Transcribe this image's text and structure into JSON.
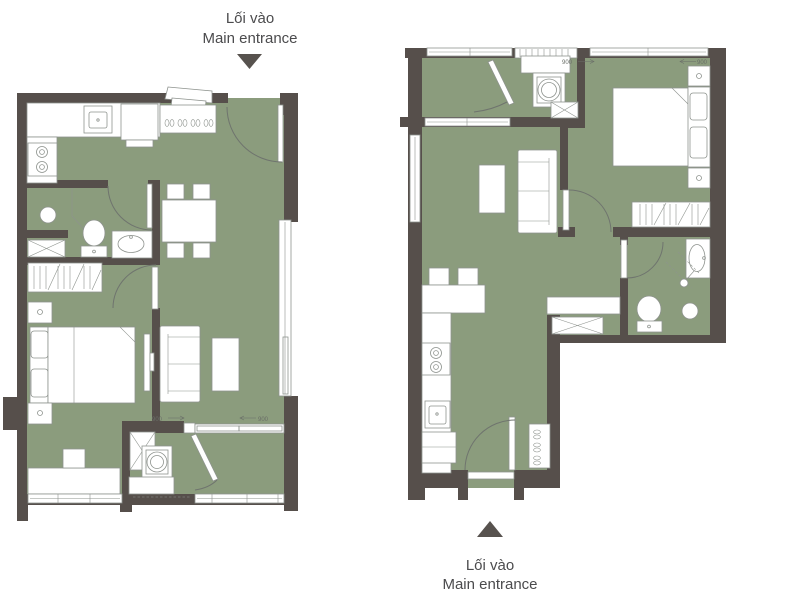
{
  "canvas": {
    "width": 800,
    "height": 602,
    "background": "#ffffff"
  },
  "colors": {
    "wall": "#564f4b",
    "floor_green": "#8b9c7d",
    "fixture_fill": "#ffffff",
    "fixture_stroke": "#8e938e",
    "door_arc": "#6f746e",
    "label_text": "#4b4b4d",
    "entrance_arrow": "#57524e",
    "dimension_text": "#6a6e68"
  },
  "top_entrance": {
    "line1": "Lối vào",
    "line2": "Main entrance"
  },
  "bottom_entrance": {
    "line1": "Lối vào",
    "line2": "Main entrance"
  },
  "dimensions": {
    "left_slide_a": "900",
    "left_slide_b": "900",
    "right_slide_a": "900",
    "right_slide_b": "900"
  },
  "plans": [
    {
      "name": "apartment-plan-left",
      "entrance": "top-right",
      "rooms": [
        "kitchen",
        "bathroom",
        "wardrobe",
        "bedroom",
        "living-dining",
        "laundry-closet",
        "balcony"
      ],
      "fixtures": [
        "kitchen-counter",
        "sink",
        "stove",
        "fridge",
        "shoe-cabinet",
        "shower",
        "toilet",
        "vanity-basin",
        "storage-cabinet",
        "bed",
        "nightstands",
        "desk",
        "stool",
        "tv",
        "sofa",
        "coffee-table",
        "dining-table",
        "dining-chairs",
        "washing-machine",
        "sliding-door",
        "windows"
      ]
    },
    {
      "name": "apartment-plan-right",
      "entrance": "bottom-left",
      "rooms": [
        "balcony",
        "laundry",
        "bedroom",
        "living",
        "hall",
        "bathroom",
        "kitchen"
      ],
      "fixtures": [
        "washing-machine",
        "storage-cabinet",
        "bed",
        "nightstands",
        "wardrobe",
        "sofa",
        "coffee-table",
        "hall-counter",
        "bathtub-basin",
        "shower",
        "toilet",
        "bar-counter",
        "bar-stools",
        "stove",
        "sink",
        "fridge",
        "shoe-cabinet",
        "windows"
      ]
    }
  ]
}
